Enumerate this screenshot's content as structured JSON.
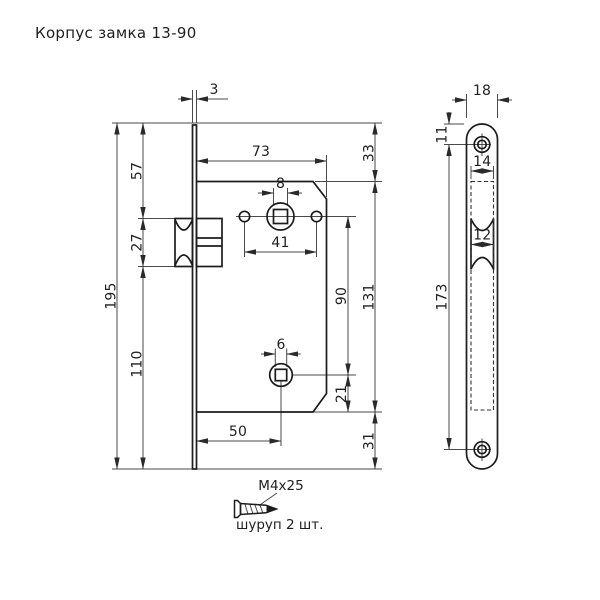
{
  "title": "Корпус замка 13-90",
  "main_view": {
    "dims": {
      "faceplate_thickness": "3",
      "body_depth": "73",
      "spindle_square_size": "8",
      "handle_holes_spacing": "41",
      "plate_top_to_body_top": "33",
      "plate_top_to_latch_top": "57",
      "latch_height": "27",
      "latch_bottom_to_plate_bottom": "110",
      "plate_height": "195",
      "spindle_to_key_centers": "90",
      "body_height": "131",
      "key_square_size": "6",
      "key_center_to_body_bottom": "21",
      "body_bottom_to_plate_bottom": "31",
      "backset": "50"
    }
  },
  "side_view": {
    "dims": {
      "plate_width": "18",
      "plate_top_to_screw_hole": "11",
      "body_slot_width": "14",
      "latch_width": "12",
      "screw_holes_spacing": "173"
    }
  },
  "screw_detail": {
    "size_label": "M4x25",
    "note": "шуруп 2 шт."
  }
}
